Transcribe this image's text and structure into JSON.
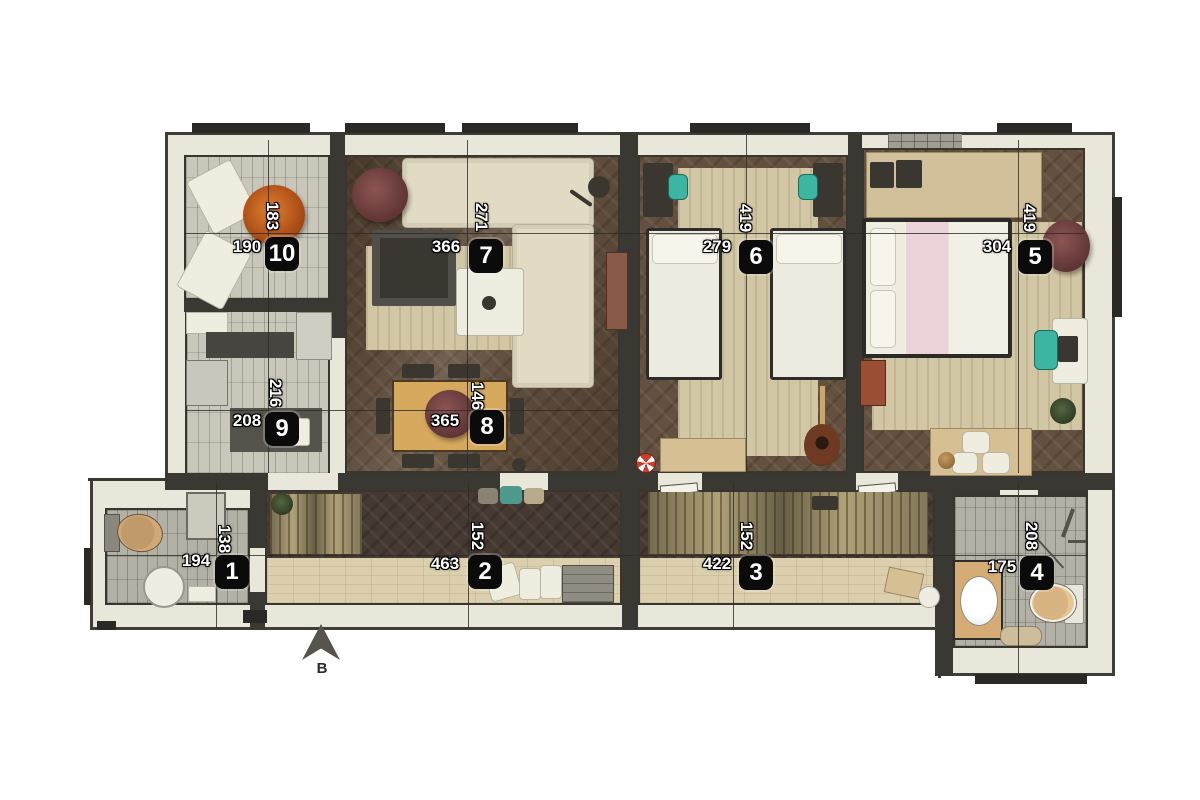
{
  "plan": {
    "compass_label": "B"
  },
  "rooms": [
    {
      "number": "1",
      "dim_vertical": "138",
      "dim_horizontal": "194"
    },
    {
      "number": "2",
      "dim_vertical": "152",
      "dim_horizontal": "463"
    },
    {
      "number": "3",
      "dim_vertical": "152",
      "dim_horizontal": "422"
    },
    {
      "number": "4",
      "dim_vertical": "208",
      "dim_horizontal": "175"
    },
    {
      "number": "5",
      "dim_vertical": "419",
      "dim_horizontal": "304"
    },
    {
      "number": "6",
      "dim_vertical": "419",
      "dim_horizontal": "279"
    },
    {
      "number": "7",
      "dim_vertical": "271",
      "dim_horizontal": "366"
    },
    {
      "number": "8",
      "dim_vertical": "146",
      "dim_horizontal": "365"
    },
    {
      "number": "9",
      "dim_vertical": "216",
      "dim_horizontal": "208"
    },
    {
      "number": "10",
      "dim_vertical": "183",
      "dim_horizontal": "190"
    }
  ],
  "colors": {
    "wall_fill": "#e9e7da",
    "wall_line": "#3f3d37",
    "badge_bg": "#0b0b0b",
    "badge_text": "#ffffff",
    "wood_floor": "#63503f",
    "light_floor": "#dbcfae",
    "tile_floor": "#c8c7ba",
    "accent_teal": "#3cb5a2",
    "accent_pink": "#ecd3da",
    "plant_orange": "#c96a2a",
    "plant_maroon": "#7c4747",
    "table_oak": "#d6a95f"
  }
}
